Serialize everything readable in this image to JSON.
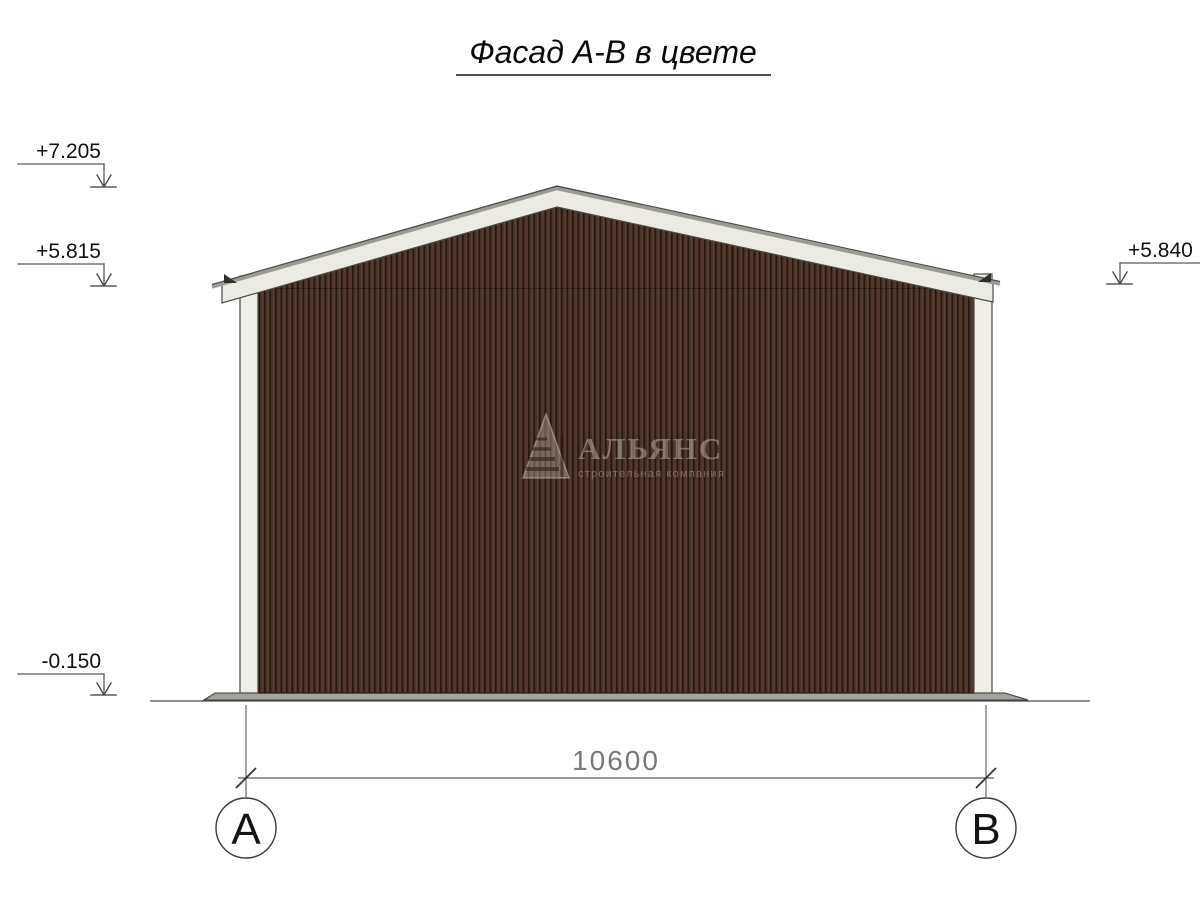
{
  "title": {
    "text": "Фасад А-В в цвете"
  },
  "elevation_marks": {
    "ridge": "+7.205",
    "eave_left": "+5.815",
    "eave_right": "+5.840",
    "ground": "-0.150"
  },
  "dimension": {
    "span": "10600"
  },
  "axes": {
    "left": {
      "label": "А"
    },
    "right": {
      "label": "В"
    }
  },
  "watermark": {
    "name": "АЛЬЯНС",
    "tagline": "строительная компания",
    "logo": "pyramid-logo"
  },
  "colors": {
    "wall_brown": "#4a3328",
    "wall_groove": "#251810",
    "wall_ridge_highlight": "#5c4133",
    "trim_white": "#ecebe3",
    "roof_lip_gray": "#9b9a94",
    "outline_dark": "#4b4b45",
    "base_gray": "#a2a29f",
    "dim_gray": "#5a5a5a",
    "text_black": "#111111"
  }
}
